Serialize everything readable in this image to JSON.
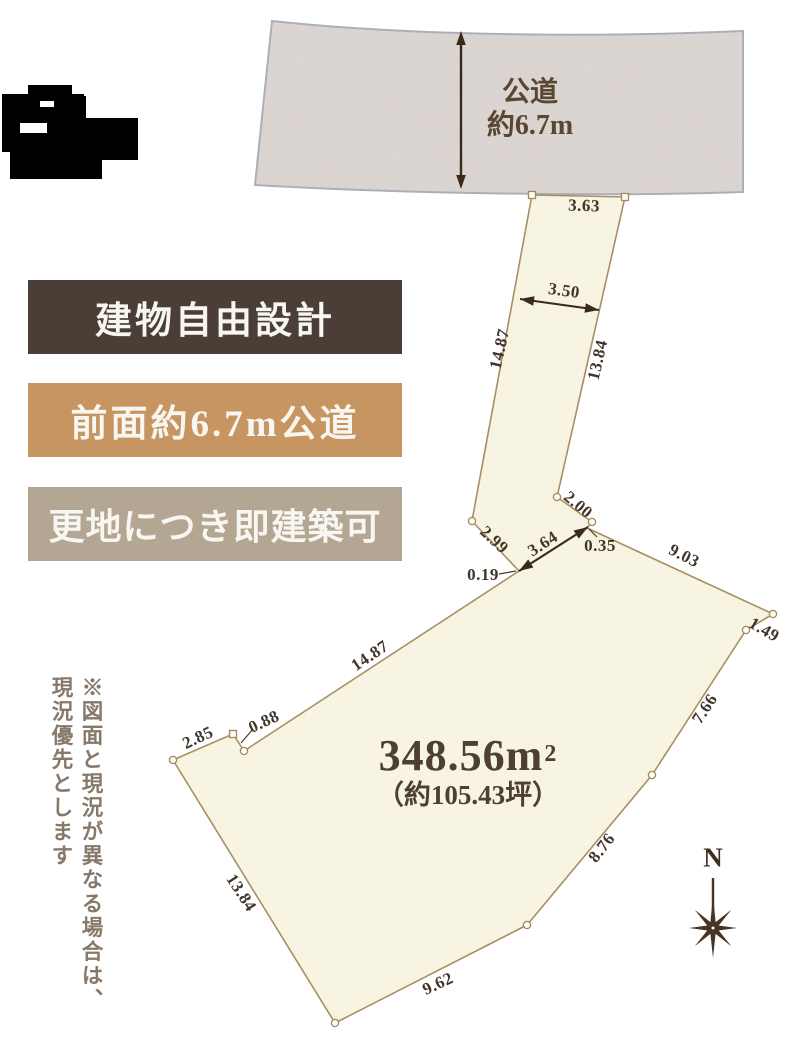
{
  "road": {
    "label_line1": "公道",
    "label_line2": "約6.7m"
  },
  "badges": [
    {
      "label": "建物自由設計"
    },
    {
      "label": "前面約6.7m公道"
    },
    {
      "label": "更地につき即建築可"
    }
  ],
  "area": {
    "main": "348.56m",
    "sup": "2",
    "tsubo": "（約105.43坪）"
  },
  "dims": {
    "d363": "3.63",
    "d350": "3.50",
    "d1487_pole": "14.87",
    "d1384_pole": "13.84",
    "d200": "2.00",
    "d299": "2.99",
    "d364": "3.64",
    "d035": "0.35",
    "d019": "0.19",
    "d903": "9.03",
    "d149": "1.49",
    "d766": "7.66",
    "d876": "8.76",
    "d962": "9.62",
    "d1384_sw": "13.84",
    "d285": "2.85",
    "d088": "0.88",
    "d1487_nw": "14.87"
  },
  "note": {
    "line1": "※図面と現況が異なる場合は、",
    "line2": "現況優先とします"
  },
  "compass": {
    "label": "N"
  },
  "colors": {
    "badge1_bg": "#4b3e37",
    "badge2_bg": "#c79562",
    "badge3_bg": "#b3a793",
    "plot_fill": "#f9f5e4",
    "plot_stroke": "#a2885c",
    "road_fill": "#dcd6d2",
    "road_stroke": "#a9aeb6",
    "ink": "#3a2d20"
  }
}
